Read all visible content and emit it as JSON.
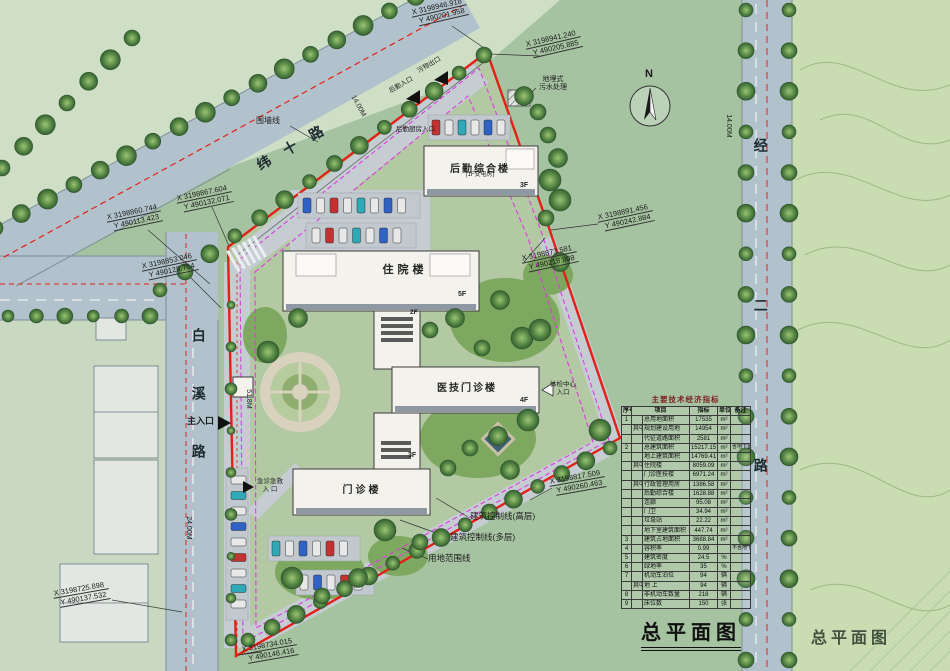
{
  "titles": {
    "main": "总平面图",
    "secondary": "总平面图"
  },
  "compass_label": "N",
  "roads": {
    "weishi": "纬十路",
    "baixi": "白溪路",
    "jinger": "经二路"
  },
  "dimensions": {
    "jinger_width": "14.00M",
    "weishi_width": "14.00M",
    "baixi_width": "24.00M",
    "site_width": "51.8M"
  },
  "buildings": {
    "houqin": {
      "label": "后勤综合楼",
      "sub": "(1F变电房)",
      "floor": "3F"
    },
    "zhuyuan": {
      "label": "住院楼",
      "floor": "5F"
    },
    "link": {
      "floor": "2F"
    },
    "yiji": {
      "label": "医技门诊楼",
      "floor": "4F"
    },
    "wing": {
      "floor": "3F"
    },
    "menzhen": {
      "label": "门诊楼"
    }
  },
  "entrances": {
    "main": "主入口",
    "emergency_l1": "急诊急救",
    "emergency_l2": "入 口",
    "checkup_l1": "体检中心",
    "checkup_l2": "入口",
    "logistics_in": "后勤入口",
    "waste_out": "污物出口",
    "kitchen": "后勤厨房入口"
  },
  "annotations": {
    "fence": "围墙线",
    "sewage_l1": "地埋式",
    "sewage_l2": "污水处理",
    "ctrl_high": "建筑控制线(高层)",
    "ctrl_multi": "建筑控制线(多层)",
    "site_boundary": "用地范围线"
  },
  "coordinates": [
    {
      "x": "X 3198946.918",
      "y": "Y 490201.958"
    },
    {
      "x": "X 3198941.240",
      "y": "Y 490205.885"
    },
    {
      "x": "X 3198867.604",
      "y": "Y 490132.071"
    },
    {
      "x": "X 3198860.744",
      "y": "Y 490113.423"
    },
    {
      "x": "X 3198853.046",
      "y": "Y 490128.764"
    },
    {
      "x": "X 3198891.456",
      "y": "Y 490242.884"
    },
    {
      "x": "X 3198873.581",
      "y": "Y 490218.808"
    },
    {
      "x": "X 3198817.509",
      "y": "Y 490260.463"
    },
    {
      "x": "X 3198725.898",
      "y": "Y 490137.532"
    },
    {
      "x": "X 3198734.015",
      "y": "Y 490148.416"
    }
  ],
  "table": {
    "title": "主要技术经济指标",
    "headers": [
      "序号",
      "项目",
      "指标",
      "单位",
      "备注"
    ],
    "rows": [
      [
        "1",
        "",
        "总用地面积",
        "17535",
        "m²",
        ""
      ],
      [
        "",
        "其中",
        "规划建设用地",
        "14954",
        "m²",
        ""
      ],
      [
        "",
        "",
        "代征道路面积",
        "2581",
        "m²",
        ""
      ],
      [
        "2",
        "",
        "总建筑面积",
        "15217.15",
        "m²",
        "含地下室"
      ],
      [
        "",
        "",
        "地上建筑面积",
        "14769.41",
        "m²",
        ""
      ],
      [
        "",
        "其中",
        "住院楼",
        "8059.09",
        "m²",
        ""
      ],
      [
        "",
        "",
        "门诊医技楼",
        "6971.24",
        "m²",
        ""
      ],
      [
        "",
        "其中",
        "行政管理用房",
        "1386.58",
        "m²",
        ""
      ],
      [
        "",
        "",
        "后勤综合楼",
        "1628.88",
        "m²",
        ""
      ],
      [
        "",
        "",
        "连廊",
        "95.08",
        "m²",
        ""
      ],
      [
        "",
        "",
        "门卫",
        "34.94",
        "m²",
        ""
      ],
      [
        "",
        "",
        "垃圾站",
        "22.22",
        "m²",
        ""
      ],
      [
        "",
        "",
        "地下室建筑面积",
        "447.74",
        "m²",
        ""
      ],
      [
        "3",
        "",
        "建筑占地面积",
        "3688.84",
        "m²",
        ""
      ],
      [
        "4",
        "",
        "容积率",
        "0.99",
        "",
        "不含地下室"
      ],
      [
        "5",
        "",
        "建筑密度",
        "24.5",
        "%",
        ""
      ],
      [
        "6",
        "",
        "绿地率",
        "35",
        "%",
        ""
      ],
      [
        "7",
        "",
        "机动车泊位",
        "94",
        "辆",
        ""
      ],
      [
        "",
        "其中",
        "地 上",
        "94",
        "辆",
        ""
      ],
      [
        "8",
        "",
        "非机动车数量",
        "218",
        "辆",
        ""
      ],
      [
        "9",
        "",
        "床位数",
        "150",
        "张",
        ""
      ]
    ]
  }
}
